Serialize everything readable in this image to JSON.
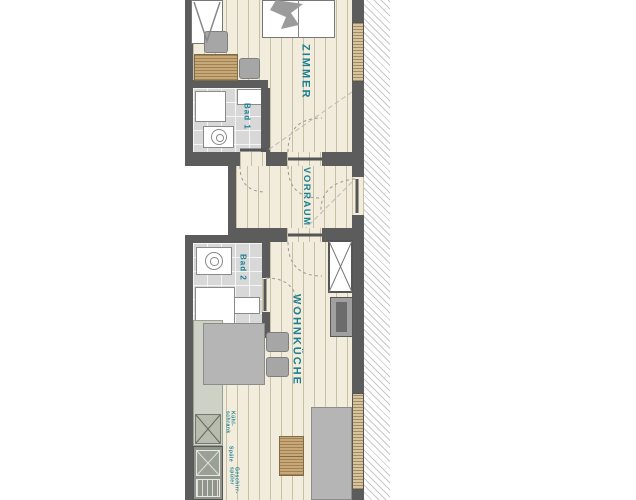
{
  "colors": {
    "accent_teal": "#1c7f92",
    "wall": "#5c5c5c",
    "wood_floor": "#f1ecdb",
    "tile": "#d8d8d8",
    "hatch": "#c8c8c8"
  },
  "rooms": {
    "zimmer": {
      "label": "ZIMMER"
    },
    "vorraum": {
      "label": "VORRAUM"
    },
    "wohnkueche": {
      "label": "WOHNKÜCHE"
    },
    "bad1": {
      "label": "Bad 1"
    },
    "bad2": {
      "label": "Bad 2"
    }
  },
  "kitchen": {
    "fridge_label": "Kühl-\nschrank",
    "sink_label": "Spüle",
    "dishwasher_label": "Geschirr-\nspüler"
  }
}
